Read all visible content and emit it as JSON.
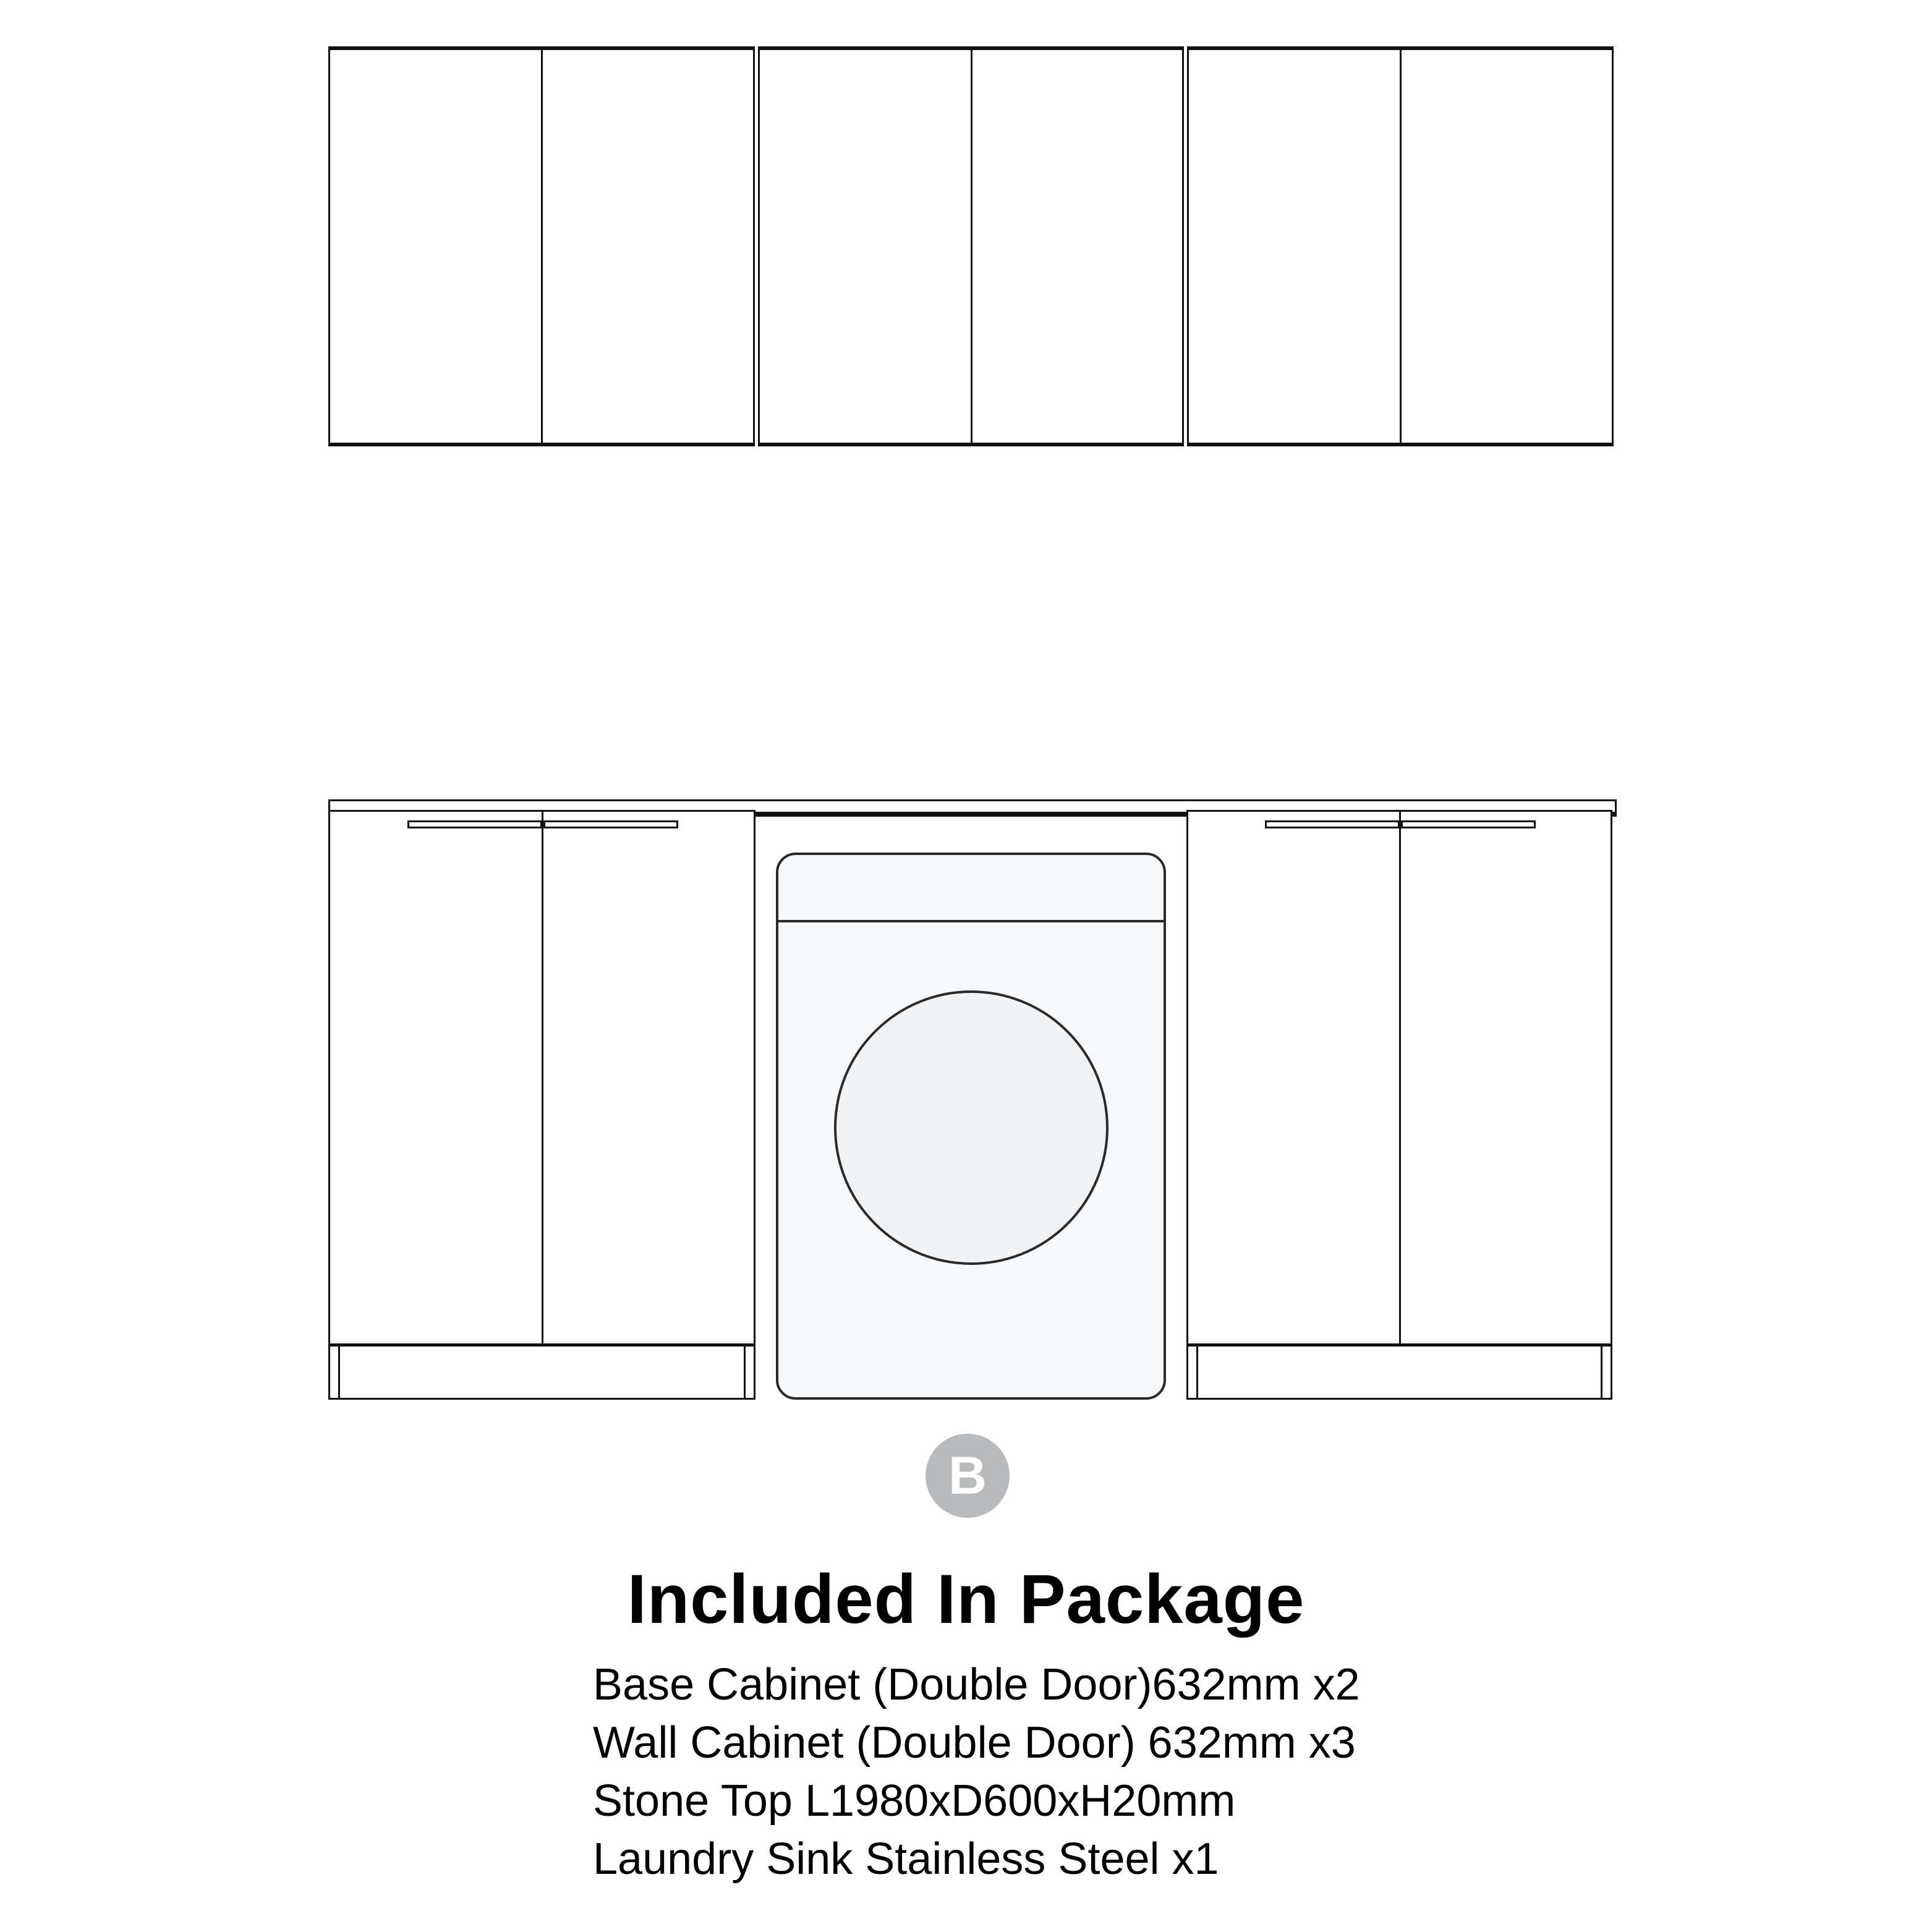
{
  "heading": {
    "title": "Included In Package"
  },
  "badge": {
    "label": "B",
    "color": "#b9babc",
    "text_color": "#ffffff"
  },
  "package": {
    "items": [
      "Base Cabinet (Double Door)632mm x2",
      "Wall Cabinet (Double Door) 632mm x3",
      "Stone Top L1980xD600xH20mm",
      "Laundry Sink Stainless Steel x1"
    ]
  },
  "diagram": {
    "line_color": "#111111",
    "washer_line_color": "#2a2a2a",
    "washer_fill": "#f7f8fa",
    "washer_door_fill": "#f1f2f4",
    "wall_cabinet_count": 3,
    "base_cabinet_count": 2
  }
}
